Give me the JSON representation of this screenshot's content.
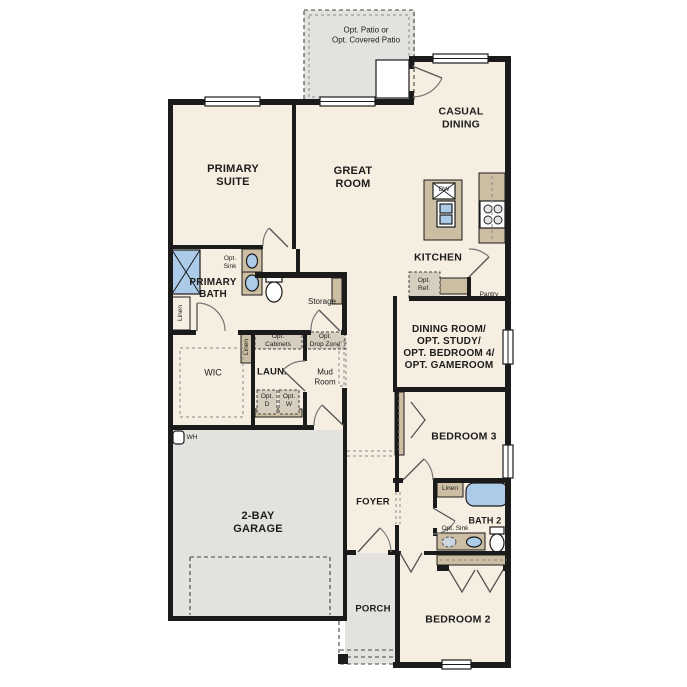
{
  "colors": {
    "floor": "#f6eee0",
    "outdoor": "#e3e2de",
    "cabinet": "#ccbea2",
    "fixture": "#abcbe9",
    "wall": "#1b1b1b"
  },
  "labels": {
    "patio": "Opt. Patio or\nOpt. Covered Patio",
    "casual_dining": "CASUAL\nDINING",
    "primary_suite": "PRIMARY\nSUITE",
    "great_room": "GREAT\nROOM",
    "kitchen": "KITCHEN",
    "dishwasher": "DW",
    "opt_sink_primary": "Opt.\nSink",
    "primary_bath": "PRIMARY\nBATH",
    "linen_primary": "Linen",
    "storage": "Storage",
    "opt_ref": "Opt.\nRef.",
    "pantry": "Pantry",
    "dining_flex": "DINING ROOM/\nOPT. STUDY/\nOPT. BEDROOM 4/\nOPT. GAMEROOM",
    "wic": "WIC",
    "linen_hall": "Linen",
    "laundry": "LAUN.",
    "opt_cabinets": "Opt.\nCabinets",
    "opt_drop_zone": "Opt.\nDrop Zone",
    "mud_room": "Mud\nRoom",
    "opt_dryer": "Opt.\nD",
    "opt_washer": "Opt.\nW",
    "bedroom3": "BEDROOM 3",
    "water_heater": "WH",
    "garage": "2-BAY\nGARAGE",
    "foyer": "FOYER",
    "linen_bath2": "Linen",
    "bath2": "BATH 2",
    "opt_sink_bath2": "Opt. Sink",
    "porch": "PORCH",
    "bedroom2": "BEDROOM 2"
  }
}
